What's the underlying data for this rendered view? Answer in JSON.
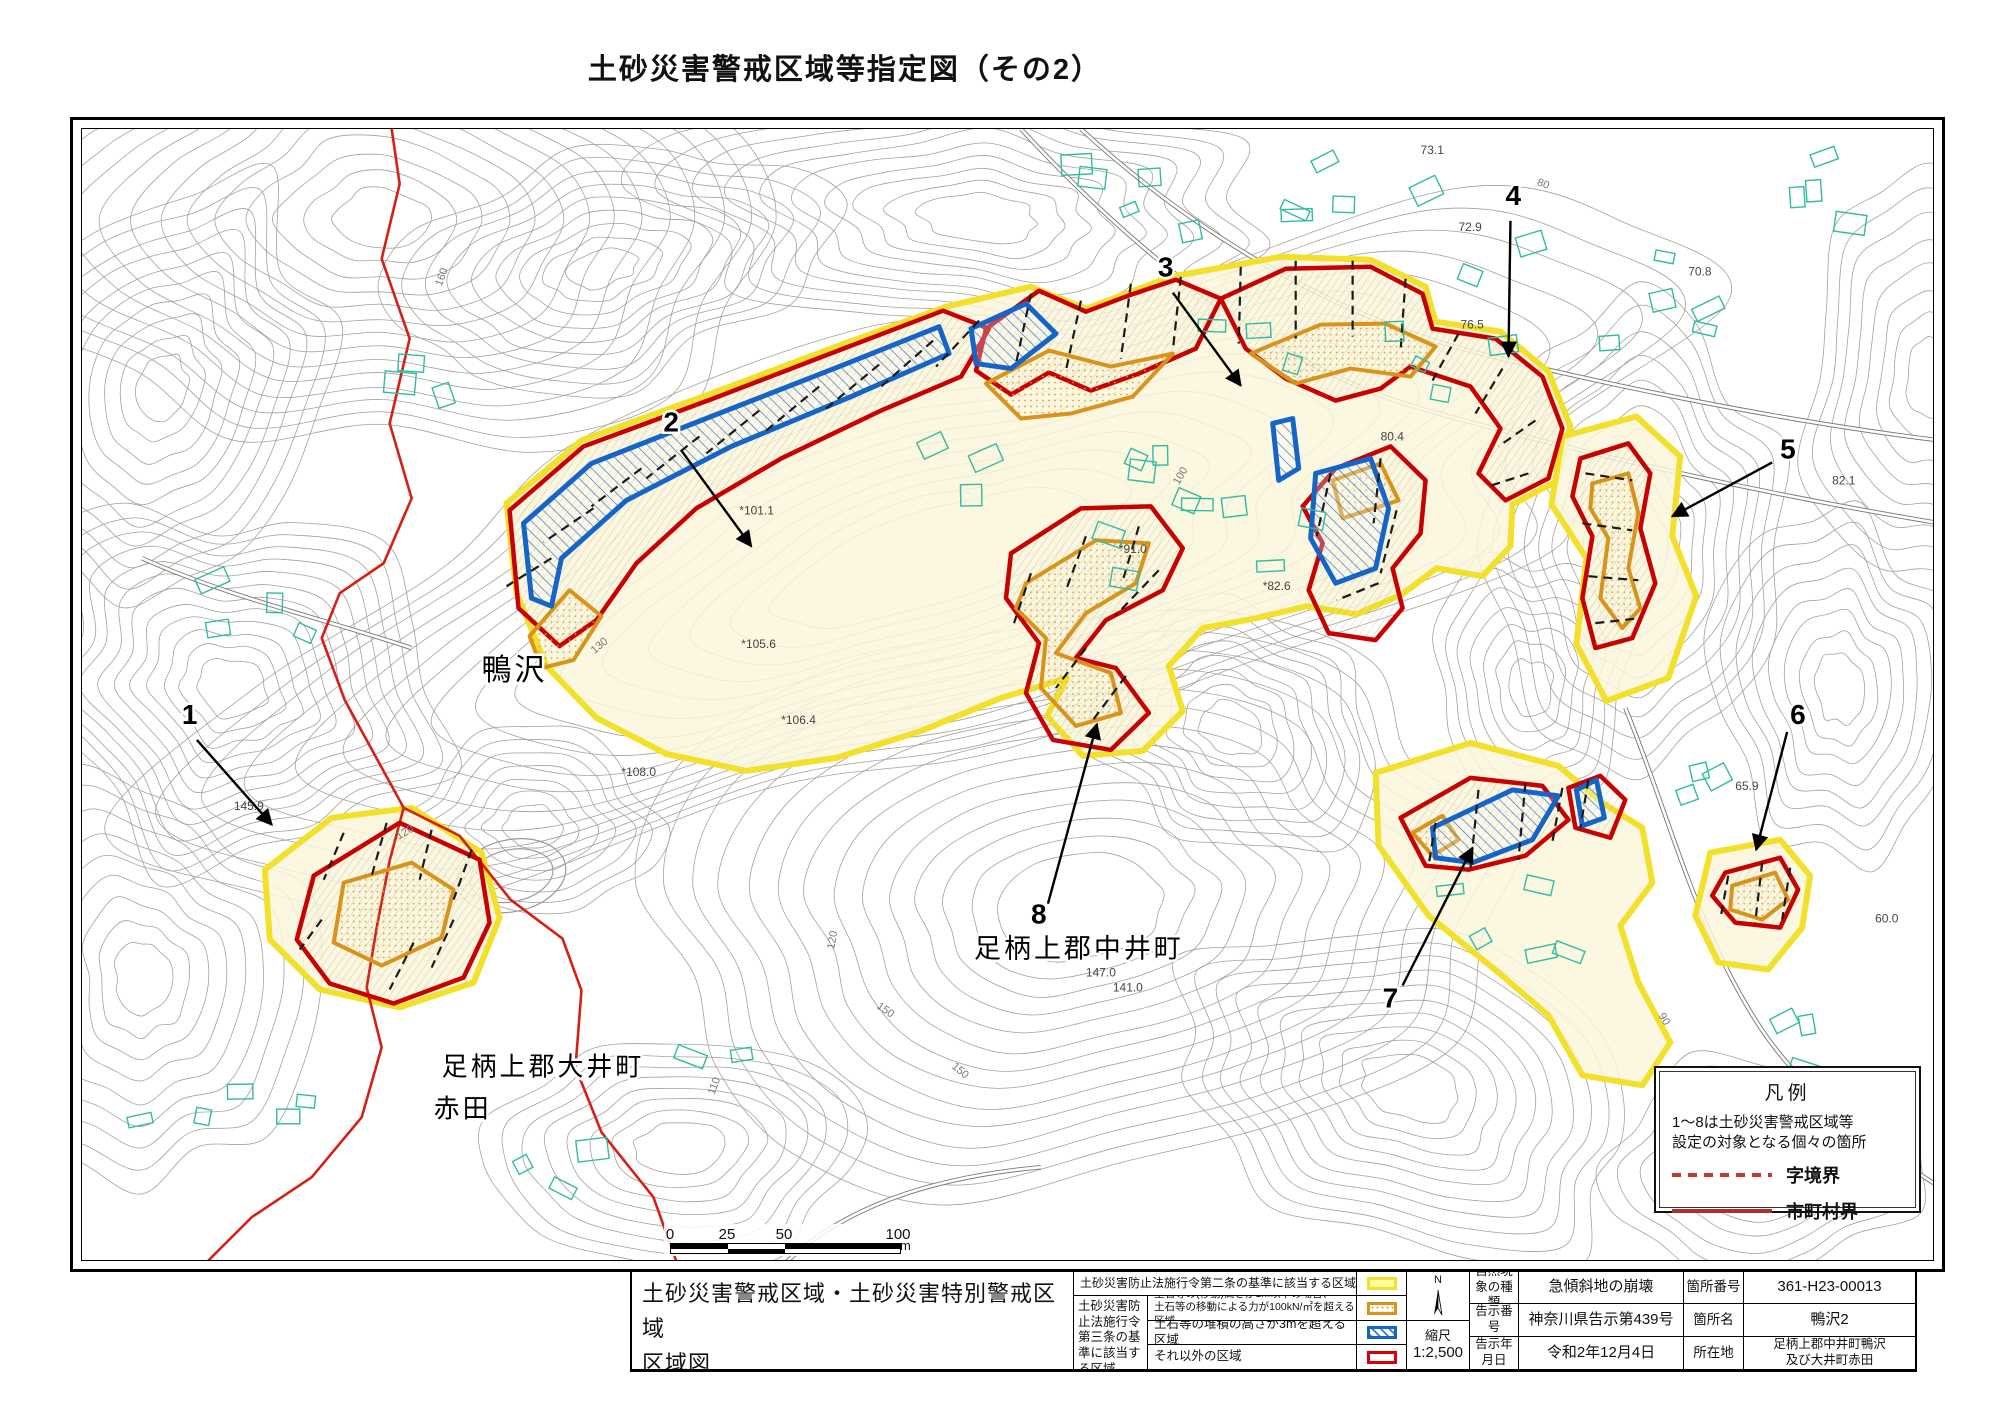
{
  "page": {
    "title": "土砂災害警戒区域等指定図（その2）"
  },
  "colors": {
    "warning_yellow": "#f2e02a",
    "warning_fill": "#faf6da",
    "special_red": "#c80000",
    "debris_orange": "#d8941a",
    "deposit_blue": "#1565c8",
    "boundary_red": "#d42015",
    "contour_gray": "#a5a29a",
    "building_teal": "#2fbca3"
  },
  "map": {
    "place_labels": [
      {
        "text": "鴨沢",
        "x": 400,
        "y": 552,
        "size": 30
      },
      {
        "text": "足柄上郡中井町",
        "x": 893,
        "y": 830,
        "size": 27
      },
      {
        "text": "足柄上郡大井町",
        "x": 360,
        "y": 948,
        "size": 26
      },
      {
        "text": "赤田",
        "x": 352,
        "y": 990,
        "size": 26
      }
    ],
    "area_markers": [
      {
        "num": "1",
        "lx": 100,
        "ly": 596,
        "x1": 115,
        "y1": 612,
        "x2": 190,
        "y2": 697
      },
      {
        "num": "2",
        "lx": 582,
        "ly": 303,
        "x1": 600,
        "y1": 322,
        "x2": 670,
        "y2": 418
      },
      {
        "num": "3",
        "lx": 1077,
        "ly": 148,
        "x1": 1092,
        "y1": 164,
        "x2": 1160,
        "y2": 257
      },
      {
        "num": "4",
        "lx": 1425,
        "ly": 76,
        "x1": 1430,
        "y1": 92,
        "x2": 1428,
        "y2": 228
      },
      {
        "num": "5",
        "lx": 1700,
        "ly": 330,
        "x1": 1692,
        "y1": 334,
        "x2": 1592,
        "y2": 388
      },
      {
        "num": "6",
        "lx": 1710,
        "ly": 596,
        "x1": 1707,
        "y1": 604,
        "x2": 1676,
        "y2": 722
      },
      {
        "num": "7",
        "lx": 1302,
        "ly": 880,
        "x1": 1322,
        "y1": 858,
        "x2": 1392,
        "y2": 720
      },
      {
        "num": "8",
        "lx": 950,
        "ly": 796,
        "x1": 967,
        "y1": 776,
        "x2": 1016,
        "y2": 596
      }
    ],
    "elevation_labels": [
      {
        "t": "73.1",
        "x": 1340,
        "y": 25
      },
      {
        "t": "72.9",
        "x": 1378,
        "y": 102
      },
      {
        "t": "76.5",
        "x": 1380,
        "y": 200
      },
      {
        "t": "70.8",
        "x": 1608,
        "y": 147
      },
      {
        "t": "80.4",
        "x": 1300,
        "y": 312
      },
      {
        "t": "*91.0",
        "x": 1038,
        "y": 425
      },
      {
        "t": "*82.6",
        "x": 1182,
        "y": 462
      },
      {
        "t": "*101.1",
        "x": 658,
        "y": 386
      },
      {
        "t": "145.9",
        "x": 152,
        "y": 682
      },
      {
        "t": "147.0",
        "x": 1005,
        "y": 849
      },
      {
        "t": "82.1",
        "x": 1752,
        "y": 356
      },
      {
        "t": "65.9",
        "x": 1655,
        "y": 662
      },
      {
        "t": "60.0",
        "x": 1795,
        "y": 795
      },
      {
        "t": "141.0",
        "x": 1032,
        "y": 864
      },
      {
        "t": "*106.4",
        "x": 700,
        "y": 596
      },
      {
        "t": "*108.0",
        "x": 540,
        "y": 648
      },
      {
        "t": "*105.6",
        "x": 660,
        "y": 520
      }
    ],
    "contour_labels": [
      {
        "t": "160",
        "x": 360,
        "y": 158,
        "r": -70
      },
      {
        "t": "150",
        "x": 795,
        "y": 880,
        "r": 35
      },
      {
        "t": "100",
        "x": 1098,
        "y": 357,
        "r": -60
      },
      {
        "t": "80",
        "x": 1456,
        "y": 56,
        "r": 20
      },
      {
        "t": "90",
        "x": 1578,
        "y": 888,
        "r": 60
      },
      {
        "t": "120",
        "x": 317,
        "y": 712,
        "r": -30
      },
      {
        "t": "120",
        "x": 753,
        "y": 822,
        "r": -80
      },
      {
        "t": "130",
        "x": 513,
        "y": 526,
        "r": -40
      },
      {
        "t": "110",
        "x": 633,
        "y": 968,
        "r": -70
      },
      {
        "t": "150",
        "x": 870,
        "y": 940,
        "r": 40
      }
    ]
  },
  "legend_box": {
    "title": "凡例",
    "note_line1": "1～8は土砂災害警戒区域等",
    "note_line2": "設定の対象となる個々の箇所",
    "dashed_label": "字境界",
    "solid_label": "市町村界"
  },
  "scale_bar": {
    "ticks": [
      "0",
      "25",
      "50",
      "100"
    ],
    "unit": "m"
  },
  "info_table": {
    "map_title_line1": "土砂災害警戒区域・土砂災害特別警戒区域",
    "map_title_line2": "区域図",
    "law2_label": "土砂災害防止法施行令第二条の基準に該当する区域",
    "law3_header": "土砂災害防止法施行令第三条の基準に該当する区域",
    "law3_rows": [
      {
        "line1": "土石等の(移動)高さが1m以下の場合、",
        "line2": "土石等の移動による力が100kN/㎡を超える区域",
        "swatch": "orange"
      },
      {
        "line1": "土石等の堆積の高さが3mを超える区域",
        "line2": "",
        "swatch": "blue"
      },
      {
        "line1": "それ以外の区域",
        "line2": "",
        "swatch": "red"
      }
    ],
    "north_label": "N",
    "scale_label": "縮尺",
    "scale_value": "1:2,500",
    "rows": [
      {
        "h1": "自然現象の種類",
        "v1": "急傾斜地の崩壊",
        "h2": "箇所番号",
        "v2": "361-H23-00013"
      },
      {
        "h1": "告示番号",
        "v1": "神奈川県告示第439号",
        "h2": "箇所名",
        "v2": "鴨沢2"
      },
      {
        "h1": "告示年月日",
        "v1": "令和2年12月4日",
        "h2": "所在地",
        "v2_line1": "足柄上郡中井町鴨沢",
        "v2_line2": "及び大井町赤田"
      }
    ]
  }
}
